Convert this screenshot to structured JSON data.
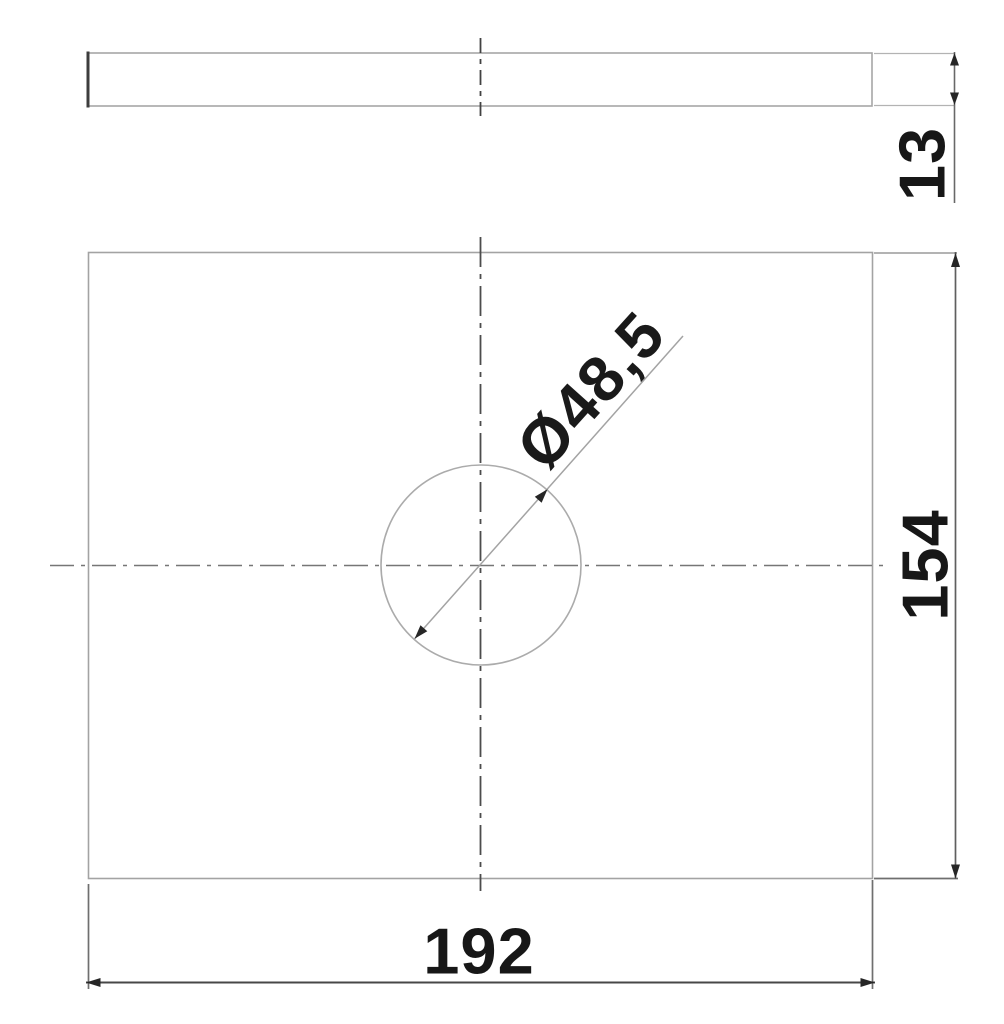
{
  "drawing": {
    "type": "technical-dimension-drawing",
    "dimensions": {
      "thickness": "13",
      "plate_height": "154",
      "plate_width": "192",
      "hole_diameter": "Ø48,5"
    },
    "colors": {
      "outline": "#a6a6a6",
      "centerline": "#5a5a5a",
      "dimension_line": "#5f5f5f",
      "arrow": "#262626",
      "text": "#171717",
      "background": "#ffffff"
    }
  }
}
